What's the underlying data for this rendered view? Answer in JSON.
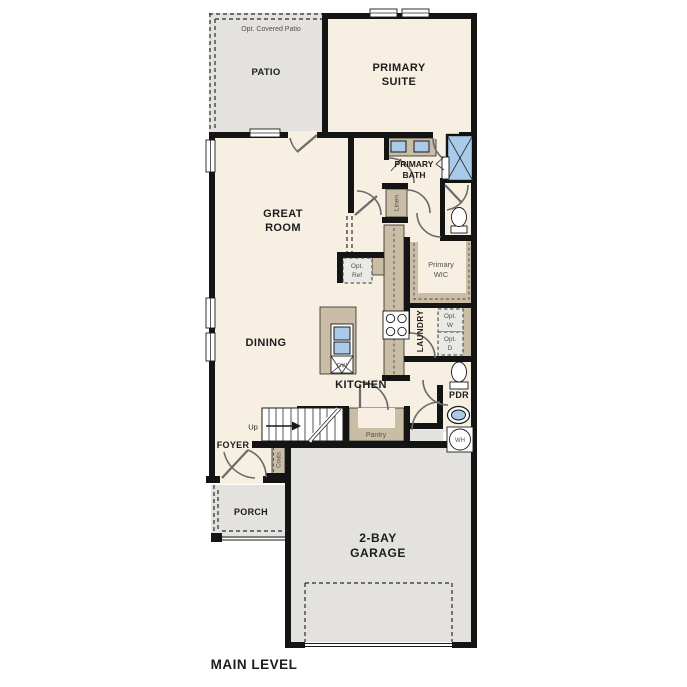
{
  "colors": {
    "wall": "#141414",
    "floor_cream": "#f6efe2",
    "exterior_gray": "#e3e2df",
    "counter_tan": "#c9bda6",
    "fixture_blue": "#a9cbe9",
    "optional_gray": "#e9e9e7",
    "label_dark": "#1c1c1c",
    "label_gray": "#55524a"
  },
  "plan": {
    "title": "MAIN LEVEL",
    "patio": {
      "note": "Opt. Covered Patio",
      "name": "PATIO"
    },
    "primary_suite": {
      "l1": "PRIMARY",
      "l2": "SUITE"
    },
    "great_room": {
      "l1": "GREAT",
      "l2": "ROOM"
    },
    "dining": "DINING",
    "kitchen": "KITCHEN",
    "primary_bath": {
      "l1": "PRIMARY",
      "l2": "BATH"
    },
    "primary_wic": {
      "l1": "Primary",
      "l2": "WIC"
    },
    "linen": "Linen",
    "laundry": "LAUNDRY",
    "opt_ref": {
      "l1": "Opt.",
      "l2": "Ref"
    },
    "opt_washer": {
      "l1": "Opt.",
      "l2": "W"
    },
    "opt_dryer": {
      "l1": "Opt.",
      "l2": "D"
    },
    "pdr": "PDR",
    "water_heater": "WH",
    "dishwasher": "DW",
    "pantry": "Pantry",
    "stairs": "Up",
    "foyer": "FOYER",
    "coats": "Coats",
    "porch": "PORCH",
    "garage": {
      "l1": "2-BAY",
      "l2": "GARAGE"
    }
  }
}
